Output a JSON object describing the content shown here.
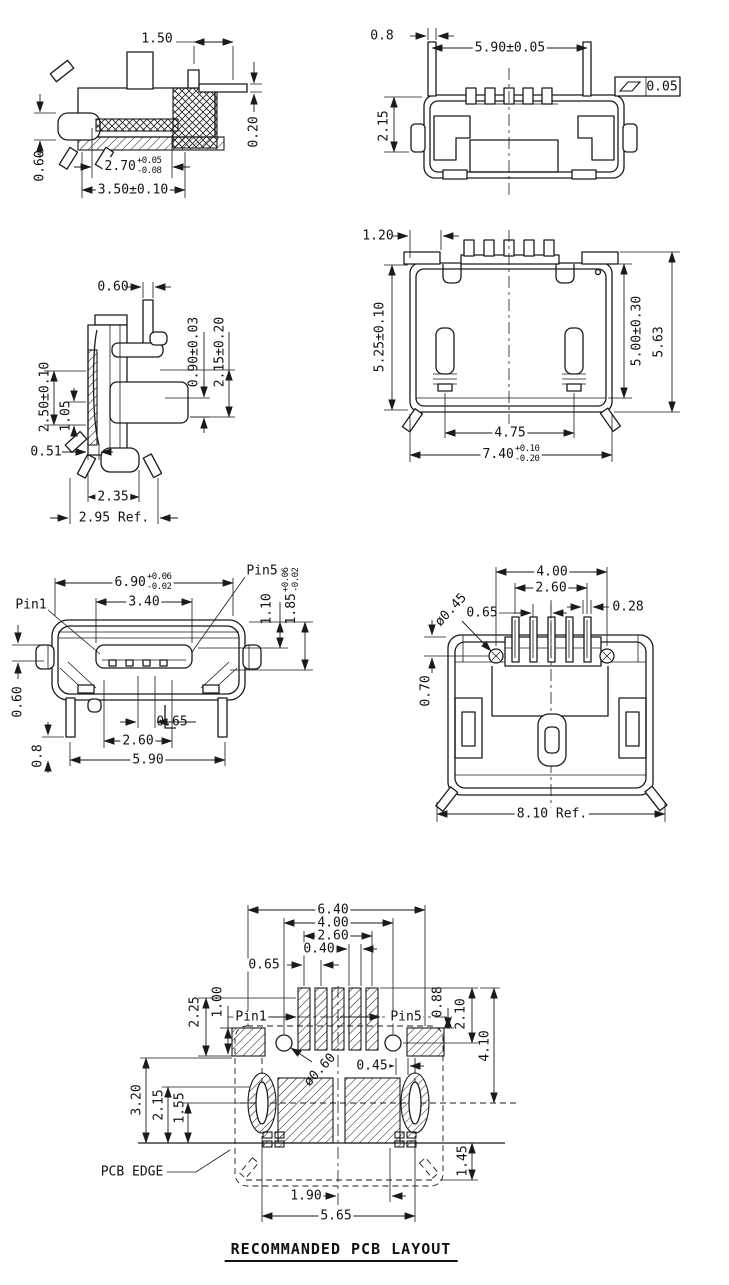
{
  "title": "RECOMMANDED PCB LAYOUT",
  "views": {
    "side_section": {
      "dims": {
        "pin_offset": "1.50",
        "lead_thickness": "0.20",
        "bump_height": "0.60",
        "depth": "2.70",
        "depth_tol_plus": "+0.05",
        "depth_tol_minus": "-0.08",
        "overall_depth": "3.50±0.10"
      }
    },
    "top_view": {
      "dims": {
        "pin_offset": "0.8",
        "pin_span": "5.90±0.05",
        "height": "2.15",
        "flatness": "0.05"
      }
    },
    "side_view": {
      "dims": {
        "stem_width": "0.60",
        "contact_thickness": "0.90±0.03",
        "contact_height": "2.15±0.20",
        "body_height": "2.50±0.10",
        "inner_height": "1.05",
        "foot_offset": "0.51",
        "foot_span": "2.35",
        "overall": "2.95 Ref."
      }
    },
    "rear_view": {
      "dims": {
        "pin_offset": "1.20",
        "body_height": "5.25±0.10",
        "shell_height": "5.00±0.30",
        "overall_height": "5.63",
        "post_span": "4.75",
        "width": "7.40",
        "width_tol_plus": "+0.10",
        "width_tol_minus": "-0.20"
      }
    },
    "front_view": {
      "labels": {
        "pin1": "Pin1",
        "pin5": "Pin5"
      },
      "dims": {
        "shell_width": "6.90",
        "shell_tol_plus": "+0.06",
        "shell_tol_minus": "-0.02",
        "opening_width": "3.40",
        "rim_height": "1.10",
        "opening_height": "1.85",
        "opening_tol_plus": "+0.06",
        "opening_tol_minus": "-0.02",
        "flange_height": "0.60",
        "pin_pitch": "0.65",
        "contact_span": "2.60",
        "body_width": "5.90",
        "leg_length": "0.8"
      }
    },
    "bottom_view": {
      "dims": {
        "hole_span": "4.00",
        "pin_span": "2.60",
        "pin_pitch": "0.65",
        "pin_width": "0.28",
        "hole_dia": "ø0.45",
        "hole_offset": "0.70",
        "overall": "8.10 Ref."
      }
    },
    "pcb_layout": {
      "labels": {
        "pin1": "Pin1",
        "pin5": "Pin5",
        "pcb_edge": "PCB EDGE"
      },
      "dims": {
        "mount_span": "6.40",
        "hole_span": "4.00",
        "pad_span": "2.60",
        "pad_width": "0.40",
        "pad_pitch": "0.65",
        "edge_offset": "2.25",
        "mount_height": "1.00",
        "pin_offset": "0.88",
        "pad_height": "2.10",
        "pad_to_slot": "4.10",
        "hole_dia": "ø0.60",
        "gap": "0.45",
        "edge_3_20": "3.20",
        "edge_2_15": "2.15",
        "edge_1_55": "1.55",
        "slot_span": "5.65",
        "center_to_pad": "1.90",
        "back_offset": "1.45"
      }
    }
  }
}
